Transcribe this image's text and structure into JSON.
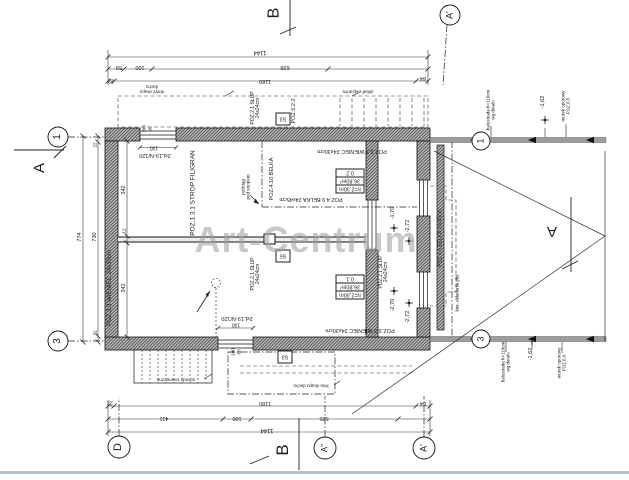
{
  "watermark": "Art-Centrum",
  "rooms": [
    {
      "id": "0.1",
      "area": "36,80m²",
      "height": "h=2,30m"
    },
    {
      "id": "0.2",
      "area": "36,80m²",
      "height": "h=2,30m"
    }
  ],
  "columns": {
    "s3": "S3",
    "s5": "S5"
  },
  "positions": {
    "strop": "POZ.1.3.1 STROP FILIGRAN",
    "wieniec": "POZ.3.3 WIENIEC 24x30cm",
    "slup": "POZ.2.1 SŁUP",
    "slup_size": "24x24cm",
    "poz522": "POZ.5.2.2",
    "belka410": "POZ.4.10 BELKA",
    "belka49": "POZ.4.9 BELKA 24x45cm",
    "belka45": "POZ.4.5 BELKA 24x45cm",
    "podciag_1": "podciąg",
    "podciag_2": "pod stropem",
    "kier": "kier. układania płyt",
    "lintel": "2xL19-N/120",
    "murek_1": "murek oporowy",
    "murek_2": "POZ.6.5",
    "balustrada_1": "balustrada h=110cm",
    "balustrada_2": "wg detalu",
    "okap_top_1": "obrys okapu",
    "okap_top_2": "dachu",
    "wiazary": "układ wiązarów",
    "schody": "schody zewnętrzne",
    "okap_bottom": "linia okapu dachu"
  },
  "levels": {
    "l170": "-1,70",
    "l272": "-2,72",
    "l270": "-2,70",
    "l162": "-1,62"
  },
  "axes": {
    "n1": "1",
    "n3": "3",
    "d": "D",
    "a_dbl": "A''",
    "a_pr": "A'",
    "b": "B",
    "a": "A"
  },
  "dims": {
    "top_total": "1144",
    "t59": "59",
    "t100": "100",
    "t628": "628",
    "t22": "22",
    "t1180": "1180",
    "t84": "84",
    "b411": "411",
    "b525": "525",
    "l774": "774",
    "l730": "730",
    "r342": "342",
    "r12": "12",
    "o130": "130",
    "o60": "60"
  }
}
